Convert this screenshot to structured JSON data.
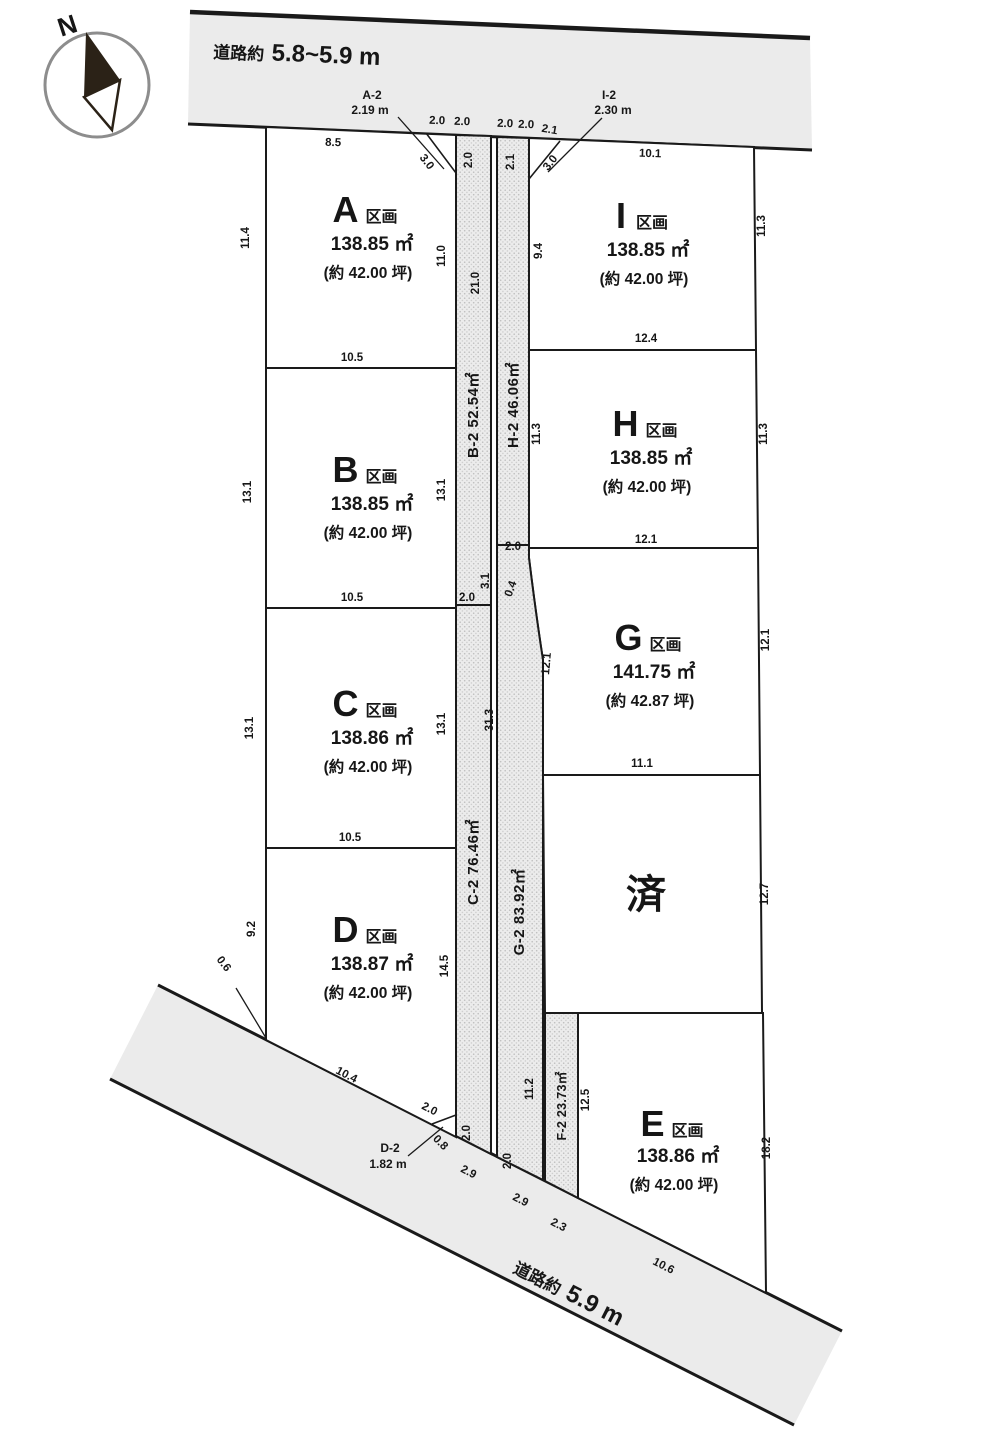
{
  "compass": {
    "label": "N"
  },
  "roads": {
    "top": {
      "prefix": "道路約",
      "value": "5.8~5.9 m"
    },
    "bottom": {
      "prefix": "道路約",
      "value": "5.9 m"
    }
  },
  "plots": [
    {
      "id": "A",
      "suffix": "区画",
      "area_m2": "138.85 ㎡",
      "area_tsubo": "(約 42.00 坪)"
    },
    {
      "id": "B",
      "suffix": "区画",
      "area_m2": "138.85 ㎡",
      "area_tsubo": "(約 42.00 坪)"
    },
    {
      "id": "C",
      "suffix": "区画",
      "area_m2": "138.86 ㎡",
      "area_tsubo": "(約 42.00 坪)"
    },
    {
      "id": "D",
      "suffix": "区画",
      "area_m2": "138.87 ㎡",
      "area_tsubo": "(約 42.00 坪)"
    },
    {
      "id": "E",
      "suffix": "区画",
      "area_m2": "138.86 ㎡",
      "area_tsubo": "(約 42.00 坪)"
    },
    {
      "id": "G",
      "suffix": "区画",
      "area_m2": "141.75 ㎡",
      "area_tsubo": "(約 42.87 坪)"
    },
    {
      "id": "H",
      "suffix": "区画",
      "area_m2": "138.85 ㎡",
      "area_tsubo": "(約 42.00 坪)"
    },
    {
      "id": "I",
      "suffix": "区画",
      "area_m2": "138.85 ㎡",
      "area_tsubo": "(約 42.00 坪)"
    }
  ],
  "sold_plot": {
    "label": "済"
  },
  "strips": {
    "labels": [
      "B-2 52.54㎡",
      "H-2 46.06㎡",
      "C-2 76.46㎡",
      "G-2 83.92㎡",
      "F-2 23.73㎡"
    ]
  },
  "corner_notes": [
    {
      "name": "A-2",
      "value": "2.19 m"
    },
    {
      "name": "I-2",
      "value": "2.30 m"
    },
    {
      "name": "D-2",
      "value": "1.82 m"
    }
  ],
  "dims": [
    "8.5",
    "2.0",
    "2.0",
    "2.0",
    "2.0",
    "2.1",
    "10.1",
    "3.0",
    "3.0",
    "2.0",
    "2.1",
    "11.4",
    "11.0",
    "21.0",
    "9.4",
    "11.3",
    "10.5",
    "12.4",
    "13.1",
    "13.1",
    "11.3",
    "11.3",
    "10.5",
    "12.1",
    "2.0",
    "3.1",
    "0.4",
    "2.0",
    "13.1",
    "13.1",
    "31.3",
    "12.1",
    "12.1",
    "10.5",
    "11.1",
    "9.2",
    "14.5",
    "12.7",
    "0.6",
    "10.4",
    "2.0",
    "0.8",
    "2.0",
    "2.0",
    "2.9",
    "2.9",
    "2.3",
    "11.2",
    "12.5",
    "18.2",
    "10.6"
  ]
}
